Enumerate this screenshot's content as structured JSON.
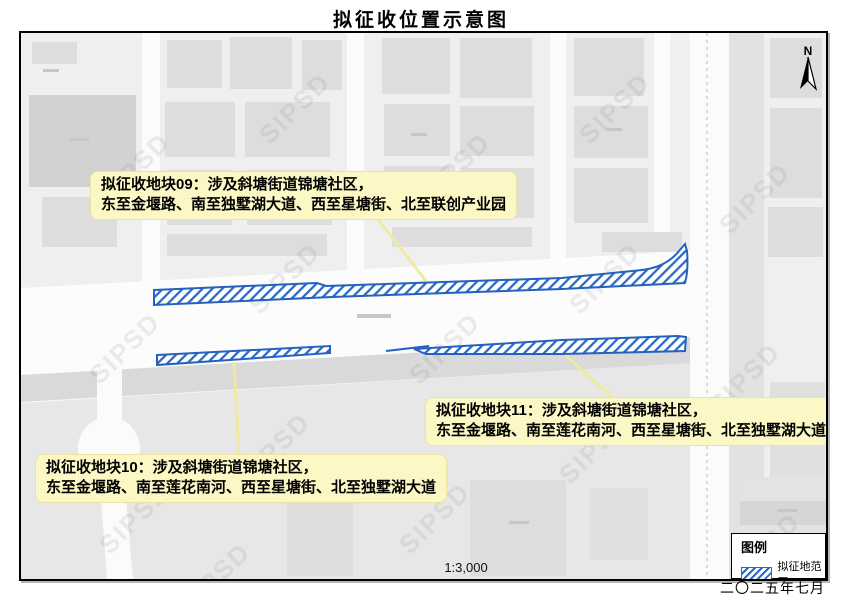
{
  "title": "拟征收位置示意图",
  "map": {
    "north_label": "N",
    "scale_text": "1:3,000",
    "watermark_text": "SIPSD"
  },
  "callouts": [
    {
      "plot": "09",
      "line1": "拟征收地块09：涉及斜塘街道锦塘社区，",
      "line2": "东至金堰路、南至独墅湖大道、西至星塘街、北至联创产业园"
    },
    {
      "plot": "10",
      "line1": "拟征收地块10：涉及斜塘街道锦塘社区，",
      "line2": "东至金堰路、南至莲花南河、西至星塘街、北至独墅湖大道"
    },
    {
      "plot": "11",
      "line1": "拟征收地块11：涉及斜塘街道锦塘社区，",
      "line2": "东至金堰路、南至莲花南河、西至星塘街、北至独墅湖大道"
    }
  ],
  "legend": {
    "title": "图例",
    "items": [
      {
        "label": "拟征地范围",
        "swatch": "blue-hatch"
      }
    ]
  },
  "footer": {
    "date": "二〇二五年七月"
  },
  "colors": {
    "hatch_blue": "#2b6bc8",
    "callout_bg": "#fcf8c6",
    "leader_yellow": "#f0e9a0"
  }
}
